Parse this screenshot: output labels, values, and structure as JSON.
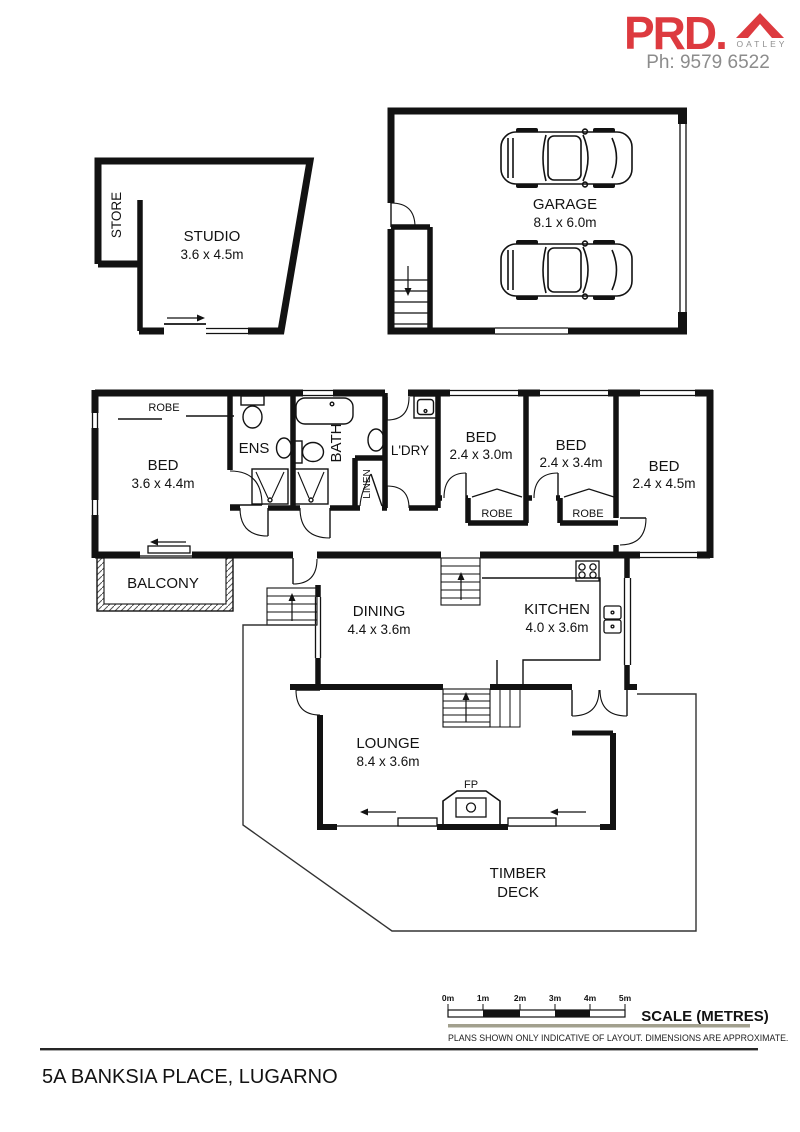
{
  "header": {
    "brand": "PRD.",
    "brand_sub": "OATLEY",
    "phone": "Ph: 9579 6522"
  },
  "rooms": {
    "store": {
      "label": "STORE"
    },
    "studio": {
      "label": "STUDIO",
      "dims": "3.6 x 4.5m"
    },
    "garage": {
      "label": "GARAGE",
      "dims": "8.1 x 6.0m"
    },
    "robe_main": {
      "label": "ROBE"
    },
    "bed_main": {
      "label": "BED",
      "dims": "3.6 x 4.4m"
    },
    "ens": {
      "label": "ENS"
    },
    "bath": {
      "label": "BATH"
    },
    "linen": {
      "label": "LINEN"
    },
    "laundry": {
      "label": "L'DRY"
    },
    "bed2": {
      "label": "BED",
      "dims": "2.4 x 3.0m"
    },
    "robe2": {
      "label": "ROBE"
    },
    "bed3": {
      "label": "BED",
      "dims": "2.4 x 3.4m"
    },
    "robe3": {
      "label": "ROBE"
    },
    "bed4": {
      "label": "BED",
      "dims": "2.4 x 4.5m"
    },
    "balcony": {
      "label": "BALCONY"
    },
    "dining": {
      "label": "DINING",
      "dims": "4.4 x 3.6m"
    },
    "kitchen": {
      "label": "KITCHEN",
      "dims": "4.0 x 3.6m"
    },
    "lounge": {
      "label": "LOUNGE",
      "dims": "8.4 x 3.6m"
    },
    "fireplace": {
      "label": "FP"
    },
    "deck": {
      "label_line1": "TIMBER",
      "label_line2": "DECK"
    }
  },
  "scale_bar": {
    "ticks": [
      "0m",
      "1m",
      "2m",
      "3m",
      "4m",
      "5m"
    ],
    "title": "SCALE (METRES)",
    "disclaimer": "PLANS SHOWN ONLY INDICATIVE OF LAYOUT.  DIMENSIONS ARE APPROXIMATE."
  },
  "footer": {
    "address": "5A BANKSIA PLACE, LUGARNO"
  },
  "colors": {
    "brand_red": "#dd3a3f",
    "muted_gray": "#8c8c8c",
    "wall": "#121212",
    "scale_rule": "#a2a08e"
  }
}
